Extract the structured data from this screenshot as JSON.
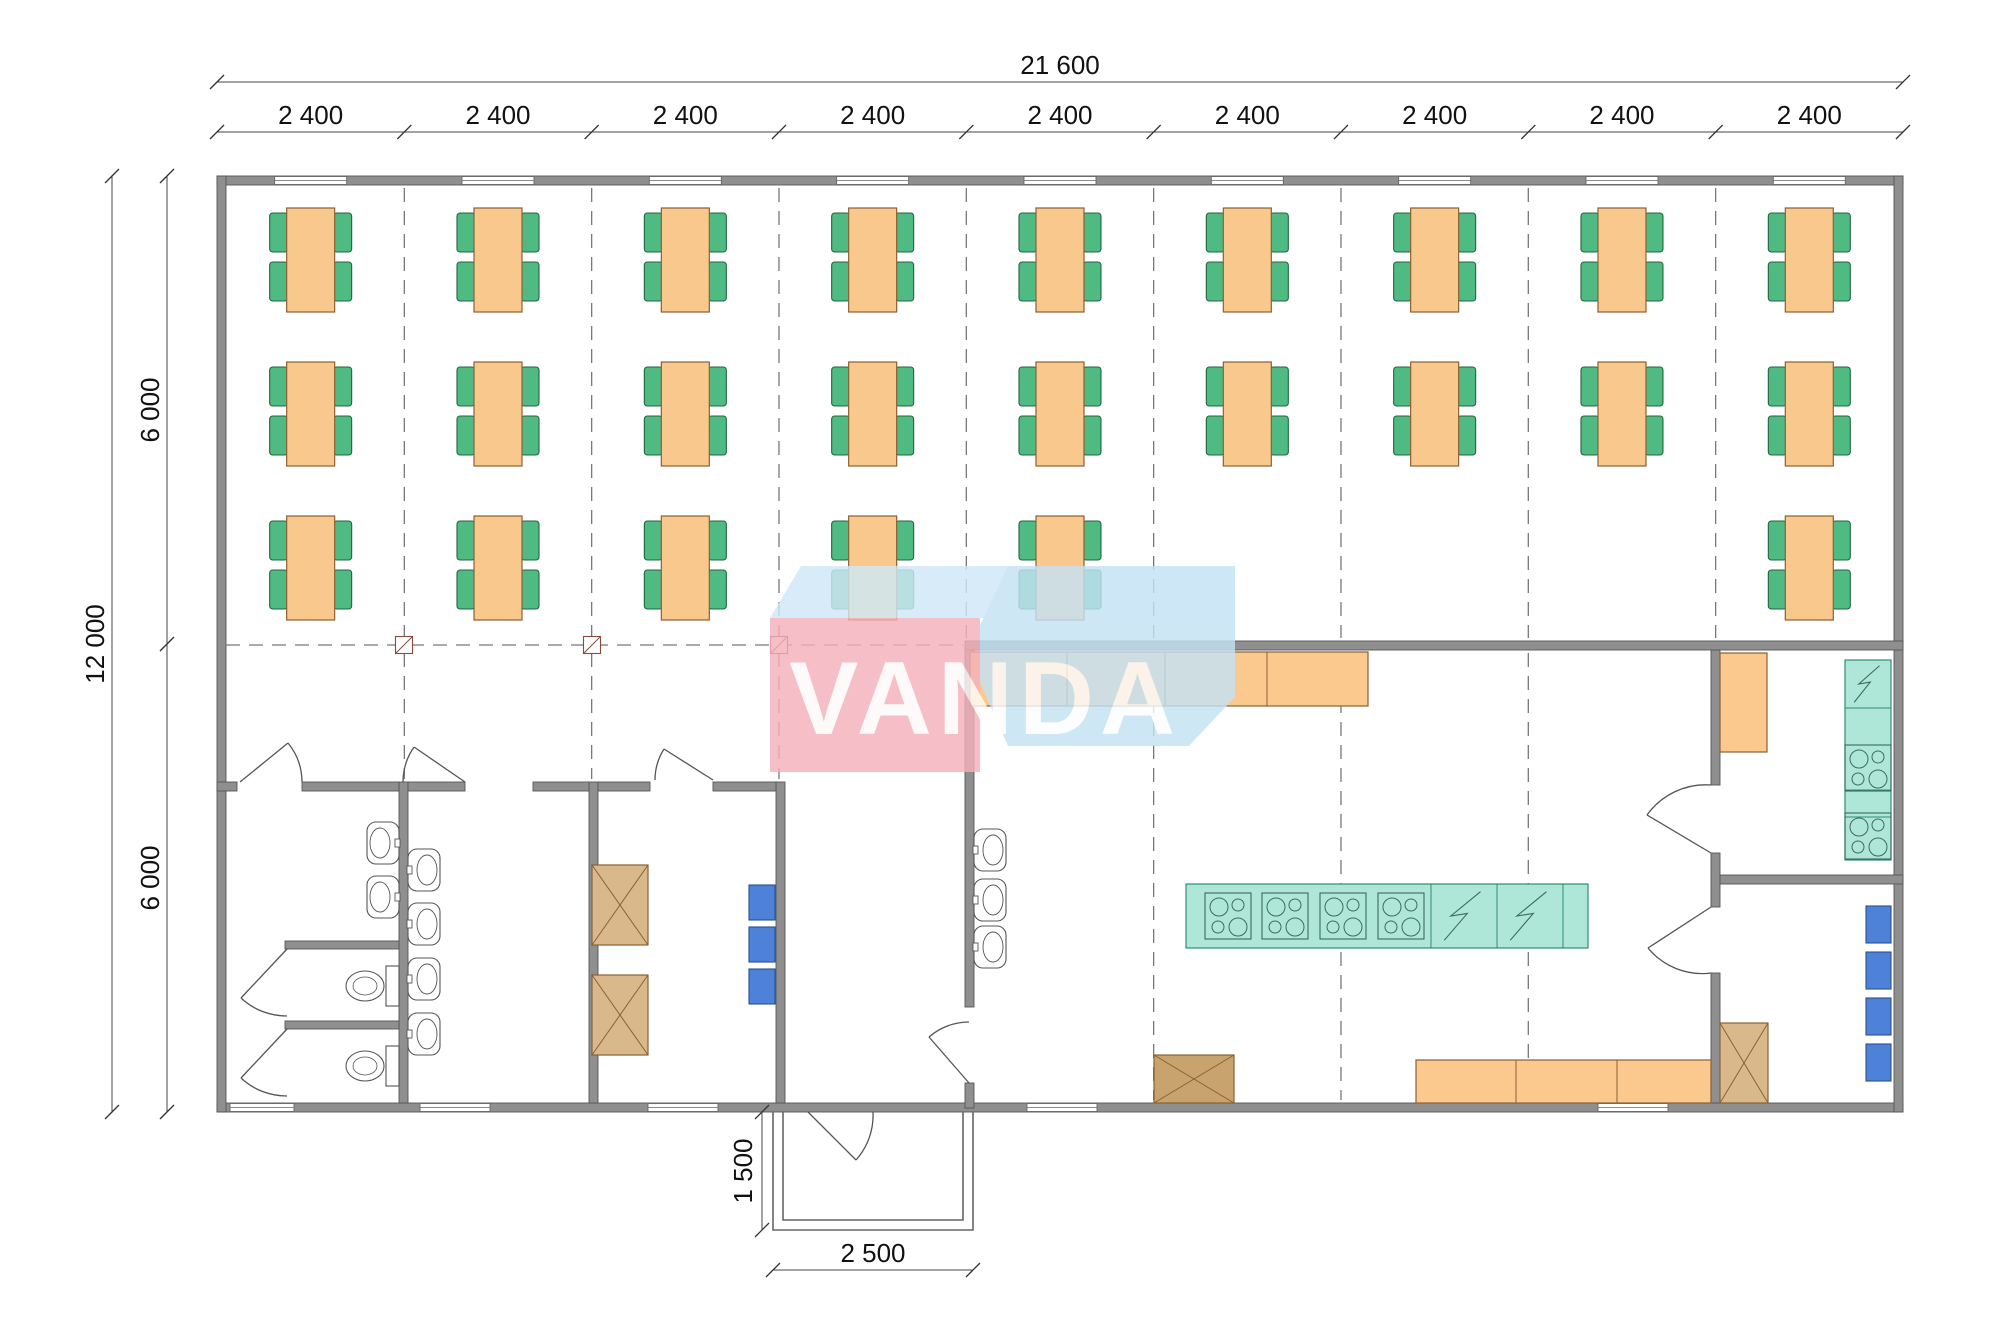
{
  "title": "Canteen module floor plan 21600 x 12000",
  "dimensions": {
    "top_total": "21 600",
    "top_segments": [
      "2 400",
      "2 400",
      "2 400",
      "2 400",
      "2 400",
      "2 400",
      "2 400",
      "2 400",
      "2 400"
    ],
    "left_total": "12 000",
    "left_segments": [
      "6 000",
      "6 000"
    ],
    "porch_depth": "1 500",
    "porch_width": "2 500"
  },
  "watermark": {
    "text": "VANDA",
    "pink": "#F5B0BA",
    "blue": "#C3E2F4",
    "blue_light": "#CFE9F7"
  },
  "colors": {
    "wall": "#8F8F8F",
    "wall_border": "#565656",
    "table": "#F9C88D",
    "table_border": "#8A6134",
    "chair": "#4FBA81",
    "chair_border": "#20663F",
    "counter": "#FBC98E",
    "teal": "#AEE7D8",
    "teal_border": "#2F8C77",
    "teal_line": "#3B6B5E",
    "locker": "#4E82D8",
    "locker_border": "#27508F",
    "cabinet_light": "#D9B98C",
    "cabinet_dark": "#C8A36E",
    "cabinet_border": "#8A6134",
    "fixture_line": "#555555",
    "dash": "#777777",
    "dim_line": "#444444"
  },
  "plan": {
    "origin_x": 217,
    "bay_w": 187.33,
    "bays": 9,
    "wall_top_y": 176,
    "wall_bottom_y": 1112,
    "windows_bottom": [
      {
        "cx": 262,
        "w": 64
      },
      {
        "cx": 455,
        "w": 70
      },
      {
        "cx": 683,
        "w": 70
      },
      {
        "cx": 1062,
        "w": 70
      },
      {
        "cx": 1633,
        "w": 70
      }
    ],
    "table_rows": [
      {
        "y": 260,
        "bays": [
          0,
          1,
          2,
          3,
          4,
          5,
          6,
          7,
          8
        ]
      },
      {
        "y": 414,
        "bays": [
          0,
          1,
          2,
          3,
          4,
          5,
          6,
          7,
          8
        ]
      },
      {
        "y": 568,
        "bays": [
          0,
          1,
          2,
          3,
          4,
          8
        ]
      }
    ],
    "sinks": [
      {
        "x": 367,
        "y": 822,
        "dir": "left"
      },
      {
        "x": 367,
        "y": 876,
        "dir": "left"
      },
      {
        "x": 408,
        "y": 849,
        "dir": "right"
      },
      {
        "x": 408,
        "y": 903,
        "dir": "right"
      },
      {
        "x": 408,
        "y": 958,
        "dir": "right"
      },
      {
        "x": 408,
        "y": 1013,
        "dir": "right"
      },
      {
        "x": 974,
        "y": 829,
        "dir": "right"
      },
      {
        "x": 974,
        "y": 879,
        "dir": "right"
      },
      {
        "x": 974,
        "y": 926,
        "dir": "right"
      }
    ],
    "toilets_y": [
      966,
      1046
    ],
    "lockers": [
      {
        "x": 749,
        "w": 26,
        "h": 35,
        "ys": [
          885,
          927,
          969
        ]
      },
      {
        "x": 1866,
        "w": 25,
        "h": 37,
        "ys": [
          906,
          952,
          998,
          1044
        ]
      }
    ],
    "cabinets": [
      {
        "x": 592,
        "y": 865,
        "w": 56,
        "h": 80,
        "tone": "light"
      },
      {
        "x": 592,
        "y": 975,
        "w": 56,
        "h": 80,
        "tone": "light"
      },
      {
        "x": 1720,
        "y": 1023,
        "w": 48,
        "h": 80,
        "tone": "light"
      },
      {
        "x": 1154,
        "y": 1055,
        "w": 80,
        "h": 48,
        "tone": "dark"
      }
    ],
    "counters": [
      {
        "x": 970,
        "y": 652,
        "w": 398,
        "h": 54,
        "div": [
          1067,
          1165,
          1267
        ]
      },
      {
        "x": 1720,
        "y": 653,
        "w": 47,
        "h": 99,
        "div": []
      },
      {
        "x": 1416,
        "y": 1060,
        "w": 295,
        "h": 43,
        "div": [
          1516,
          1617
        ]
      }
    ],
    "island": {
      "x": 1186,
      "y": 884,
      "w": 402,
      "h": 64,
      "stove_x": [
        1205,
        1262,
        1320,
        1378
      ],
      "stove_y": 893,
      "stove_s": 46,
      "lines": [
        1431,
        1497,
        1563
      ],
      "zig": [
        [
          1431,
          66
        ],
        [
          1497,
          66
        ]
      ]
    },
    "right_counter": {
      "x": 1845,
      "y": 660,
      "w": 46,
      "h": 200,
      "lines": [
        708,
        745,
        790,
        817
      ],
      "stove_y": [
        745,
        813
      ],
      "zig_y": 660
    },
    "columns_x": [
      404,
      592,
      779
    ],
    "columns_y": 645
  }
}
